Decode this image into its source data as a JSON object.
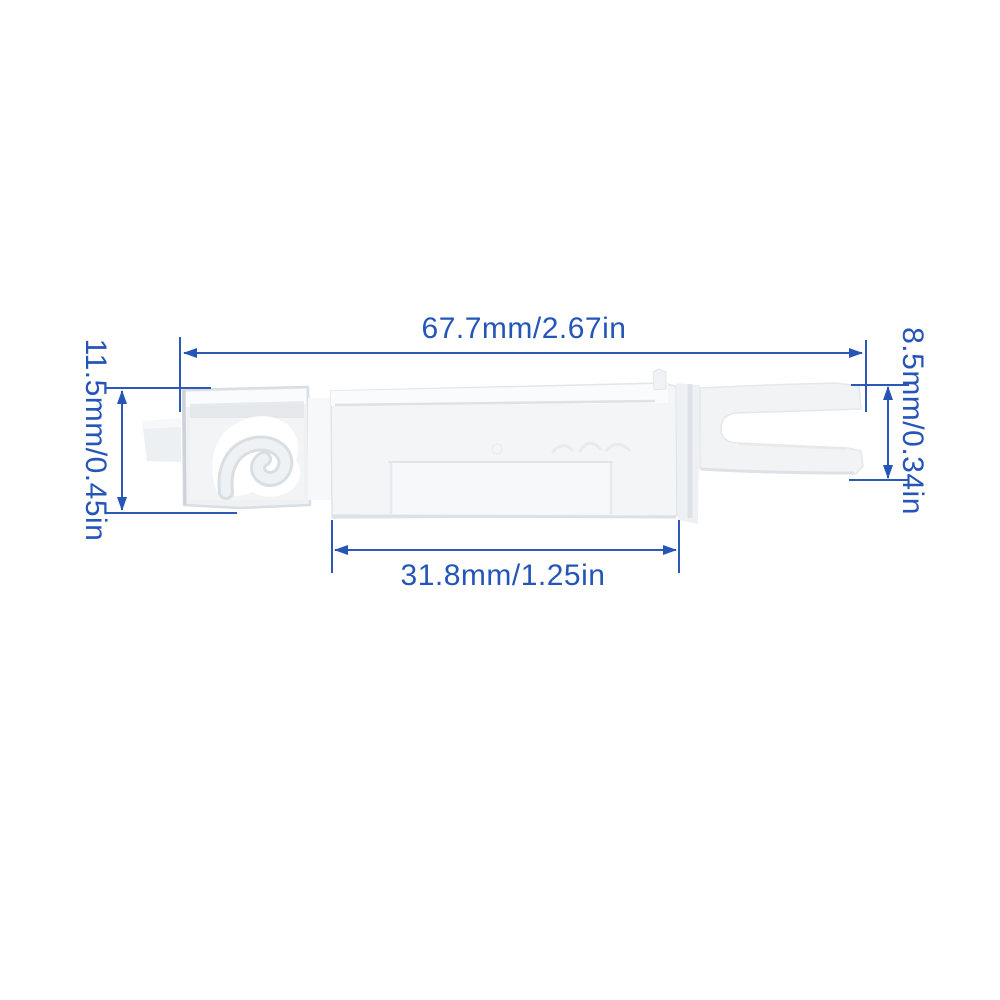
{
  "annotation": {
    "color": "#2455b7",
    "labels": {
      "top_width": "67.7mm/2.67in",
      "left_height": "11.5mm/0.45in",
      "right_height": "8.5mm/0.34in",
      "bottom_width": "31.8mm/1.25in"
    }
  },
  "product": {
    "background_color": "#ffffff",
    "part_fill_color": "#f3f5f7",
    "part_edge_color": "#dde2e6"
  }
}
